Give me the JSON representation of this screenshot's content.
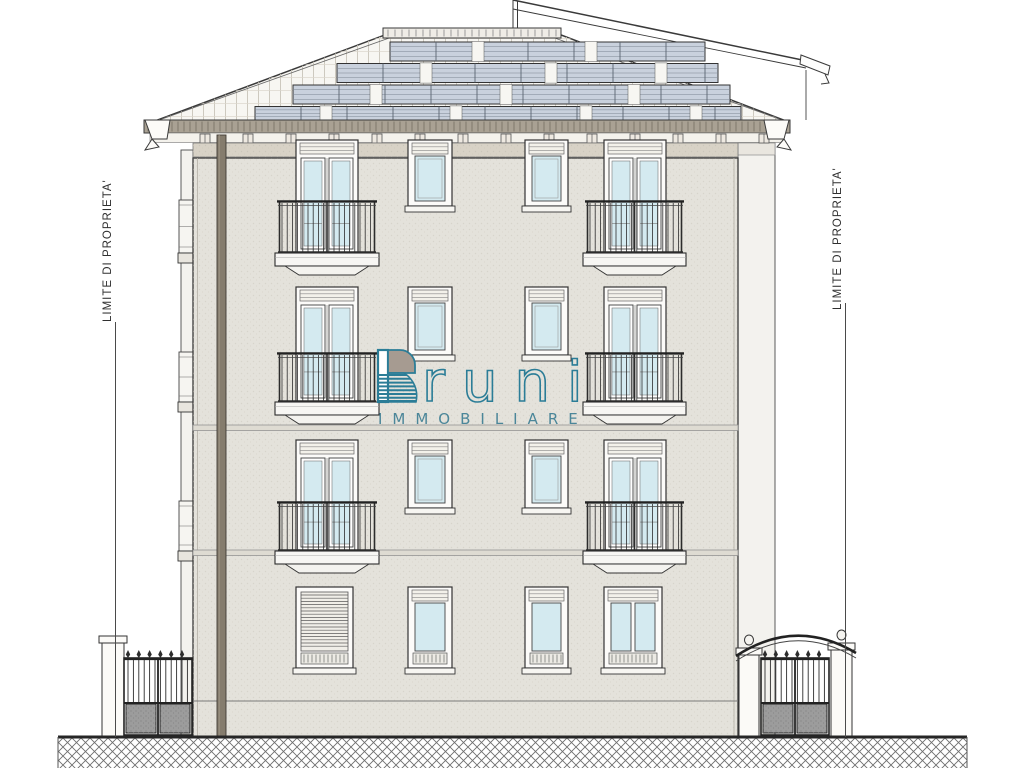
{
  "labels": {
    "property_boundary_left": "LIMITE DI PROPRIETA'",
    "property_boundary_right": "LIMITE DI PROPRIETA'"
  },
  "watermark": {
    "brand_full": "Bruni",
    "brand_initial": "B",
    "brand_rest": "runi",
    "subtitle": "IMMOBILIARE",
    "accent_color": "#2b7d97",
    "subtitle_color": "#4b8699",
    "lobe_fill": "#a69b91"
  },
  "colors": {
    "line": "#3a3a3a",
    "facade": "#e4e2db",
    "cornice": "#d8d2c6",
    "fascia": "#a9a193",
    "soffit": "#f4f2ec",
    "roof": "#f7f6f2",
    "glass": "#d4eaf0",
    "frame": "#fcfbf9",
    "downspout": "#857c6d",
    "solar_panel": "#c9d1dd",
    "solar_grid": "#5a6470",
    "gate_panel": "#9c9c9c",
    "side_wall": "#f3f2ee",
    "string_course": "#dedbd2"
  }
}
